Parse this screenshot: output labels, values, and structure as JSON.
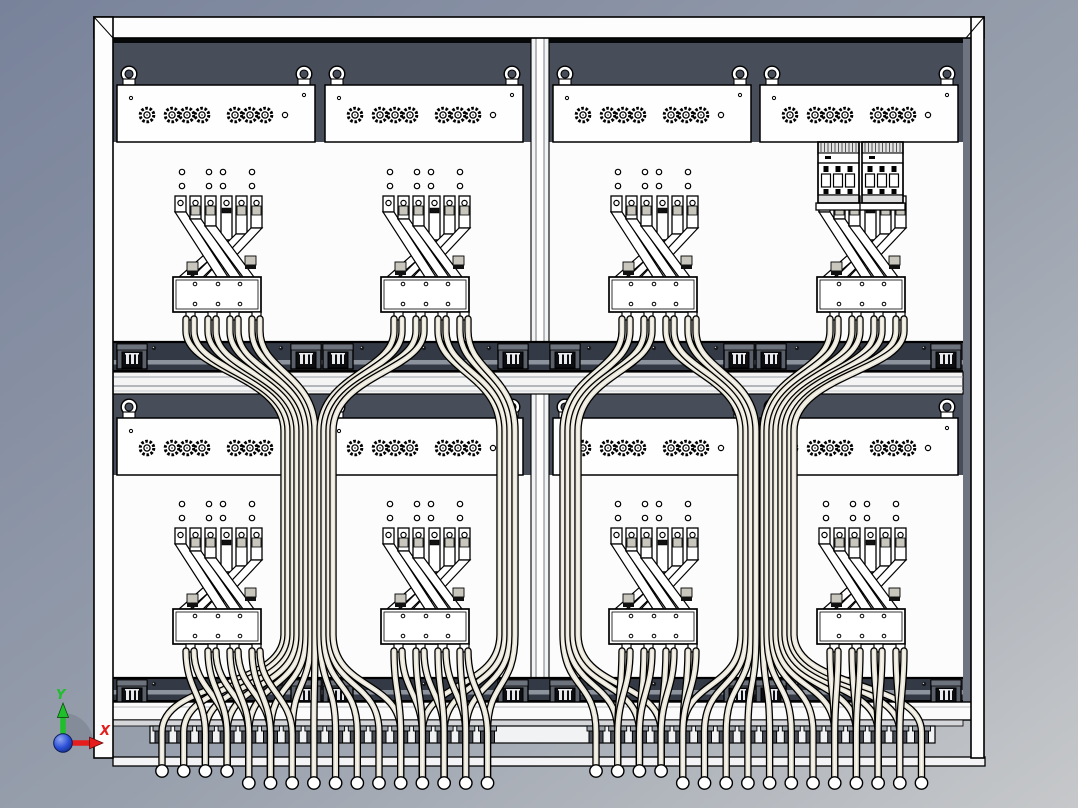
{
  "scene": {
    "kind": "cad-front-view",
    "subject": "electrical distribution cabinet wiring assembly"
  },
  "triad": {
    "y_label": "Y",
    "x_label": "X"
  },
  "palette": {
    "bg0": "#78829a",
    "bg1": "#98a0ad",
    "bg2": "#c6c8ca",
    "dark": "#474d59",
    "recess": "#343a45",
    "face": "#6e7580",
    "panel": "#fcfcfd",
    "frame": "#fdfdfd",
    "wire": "#e9e6d9",
    "wire_hi": "#f8f6ef",
    "axis_y": "#1fbf2b",
    "axis_x": "#e51d1d",
    "axis_z_light": "#8fa6f0",
    "axis_z": "#2b50d8",
    "axis_z_dark": "#10266f"
  },
  "layout": {
    "canvas": {
      "w": 1078,
      "h": 808
    },
    "interior": {
      "x": 113,
      "y": 38,
      "w": 850,
      "h": 664
    },
    "frame": {
      "top": [
        94,
        17,
        890,
        21
      ],
      "left": [
        94,
        17,
        19,
        741
      ],
      "right": [
        971,
        17,
        13,
        741
      ],
      "face": [
        963,
        38,
        8,
        664
      ],
      "bottom_band": [
        96,
        702,
        886,
        18
      ],
      "base_strip": [
        113,
        757,
        872,
        9
      ]
    },
    "divider": {
      "x": 531,
      "y": 38,
      "w": 18,
      "h": 664
    },
    "modules": {
      "lefts": [
        117,
        325,
        553,
        760
      ],
      "rows": [
        85,
        418
      ],
      "w": 198,
      "h": 57,
      "eyebolt_offsets": [
        12,
        187
      ],
      "conn_big": [
        30,
        55,
        70,
        85,
        118,
        133,
        148
      ],
      "conn_small": 168
    },
    "assemblies": {
      "centers": [
        217,
        425,
        653,
        861
      ],
      "rows_t": [
        196,
        528
      ],
      "breaker_row": 0,
      "breaker_index": 3,
      "breaker_x": [
        818,
        862
      ]
    },
    "recess": {
      "ys": [
        341,
        677
      ],
      "hs": [
        31,
        25
      ],
      "block_centers": [
        132,
        306,
        338,
        513,
        565,
        739,
        771,
        946
      ],
      "dot_xs": [
        154,
        219,
        281,
        362,
        424,
        489,
        589,
        654,
        716,
        797,
        859,
        924
      ]
    },
    "midrail": [
      113,
      372,
      850,
      22
    ],
    "gland_rail": [
      150,
      726,
      785,
      17
    ],
    "glands": {
      "left_start": 162,
      "right_start": 596,
      "pitch": 21.7,
      "count": 16,
      "short_count": 4,
      "tip_short": 771,
      "tip_long": 783
    },
    "wires": {
      "sy_row1": 319,
      "sy_row2": 651,
      "row1": [
        {
          "sx": [
            186,
            194,
            208,
            216,
            230,
            238,
            252,
            260
          ],
          "bx": [
            284,
            288,
            293,
            297,
            302,
            306,
            311,
            315
          ],
          "g": "L",
          "gi": [
            0,
            1,
            2,
            3,
            4,
            5,
            6,
            7
          ]
        },
        {
          "sx": [
            394,
            402,
            416,
            424,
            438,
            446,
            460,
            468
          ],
          "bx": [
            320,
            324,
            329,
            333,
            500,
            505,
            510,
            515
          ],
          "g": "L",
          "gi": [
            8,
            9,
            10,
            11,
            12,
            13,
            14,
            15
          ]
        },
        {
          "sx": [
            622,
            630,
            644,
            652,
            666,
            674,
            688,
            696
          ],
          "bx": [
            563,
            568,
            573,
            578,
            741,
            746,
            751,
            756
          ],
          "g": "R",
          "gi": [
            0,
            1,
            2,
            3,
            4,
            5,
            6,
            7
          ]
        },
        {
          "sx": [
            830,
            838,
            852,
            860,
            874,
            882,
            896,
            904
          ],
          "bx": [
            763,
            767,
            772,
            776,
            781,
            785,
            790,
            794
          ],
          "g": "R",
          "gi": [
            8,
            9,
            10,
            11,
            12,
            13,
            14,
            15
          ]
        }
      ],
      "row2": [
        {
          "sx": [
            186,
            194,
            208,
            216,
            230,
            238,
            252,
            260
          ],
          "g": "L",
          "gi": [
            2,
            3,
            3,
            4,
            4,
            5,
            5,
            6
          ]
        },
        {
          "sx": [
            394,
            402,
            416,
            424,
            438,
            446,
            460,
            468
          ],
          "g": "L",
          "gi": [
            11,
            12,
            12,
            13,
            13,
            14,
            14,
            15
          ]
        },
        {
          "sx": [
            622,
            630,
            644,
            652,
            666,
            674,
            688,
            696
          ],
          "g": "R",
          "gi": [
            1,
            1,
            2,
            2,
            3,
            3,
            4,
            4
          ]
        },
        {
          "sx": [
            830,
            838,
            852,
            860,
            874,
            882,
            896,
            904
          ],
          "g": "R",
          "gi": [
            11,
            11,
            12,
            12,
            13,
            13,
            14,
            14
          ]
        }
      ]
    },
    "triad": {
      "ox": 63,
      "oy": 743
    }
  }
}
